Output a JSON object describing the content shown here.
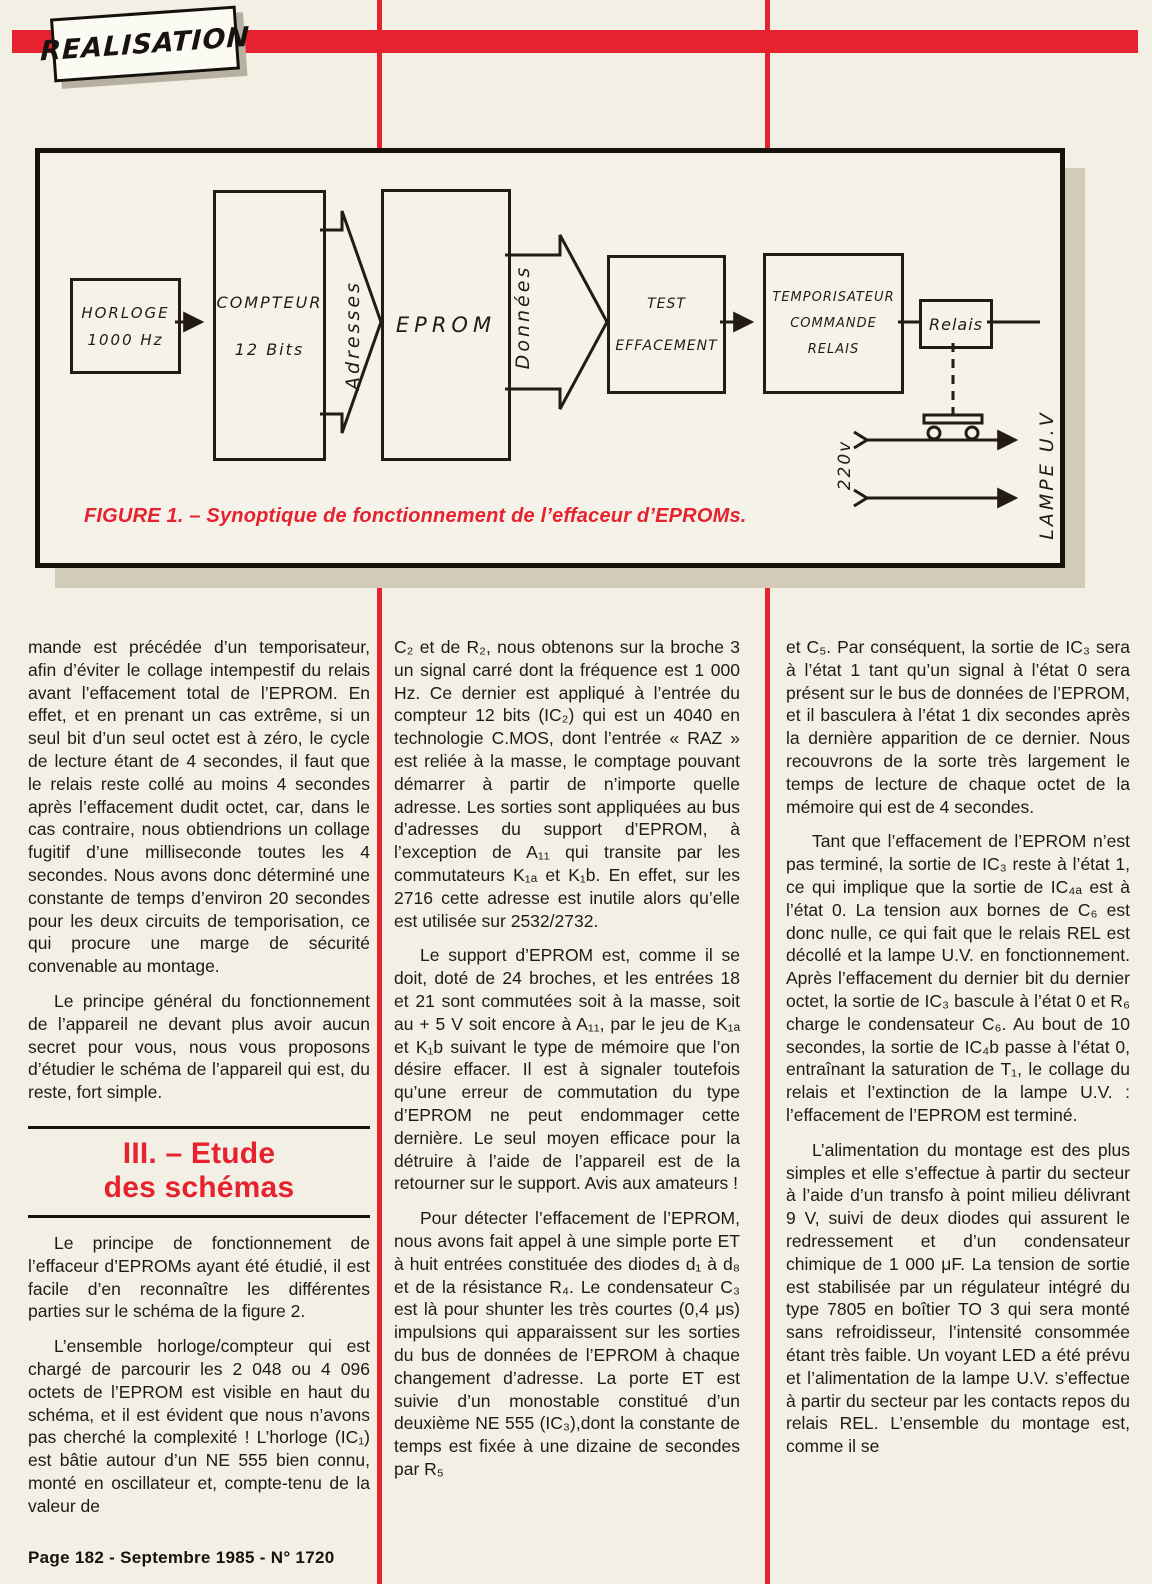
{
  "page": {
    "background": "#f2efe5",
    "accent": "#e6222e",
    "ink": "#201a14",
    "footer": "Page 182 - Septembre 1985 - N° 1720"
  },
  "masthead": {
    "badge": "REALISATION"
  },
  "figure1": {
    "caption": "FIGURE 1. – Synoptique de fonctionnement de l’effaceur d’EPROMs.",
    "blocks": {
      "horloge": {
        "line1": "HORLOGE",
        "line2": "1000 Hz"
      },
      "compteur": {
        "line1": "COMPTEUR",
        "line2": "12 Bits"
      },
      "eprom": {
        "line1": "EPROM"
      },
      "test": {
        "line1": "TEST",
        "line2": "EFFACEMENT"
      },
      "temporisateur": {
        "line1": "TEMPORISATEUR",
        "line2": "COMMANDE",
        "line3": "RELAIS"
      },
      "relais": {
        "line1": "Relais"
      }
    },
    "bus_labels": {
      "adresses": "Adresses",
      "donnees": "Données"
    },
    "wire_labels": {
      "mains": "220v",
      "lamp": "LAMPE U.V"
    }
  },
  "article": {
    "col1": {
      "p1": "mande est précédée d’un temporisateur, afin d’éviter le collage intempestif du relais avant l’effacement total de l’EPROM. En effet, et en prenant un cas extrême, si un seul bit d’un seul octet est à zéro, le cycle de lecture étant de 4 secondes, il faut que le relais reste collé au moins 4 secondes après l’effacement dudit octet, car, dans le cas contraire, nous obtiendrions un collage fugitif d’une milliseconde toutes les 4 secondes. Nous avons donc déterminé une constante de temps d’environ 20 secondes pour les deux circuits de temporisation, ce qui procure une marge de sécurité convenable au montage.",
      "p2": "Le principe général du fonctionnement de l’appareil ne devant plus avoir aucun secret pour vous, nous vous proposons d’étudier le schéma de l’appareil qui est, du reste, fort simple.",
      "heading_line1": "III. – Etude",
      "heading_line2": "des schémas",
      "p3": "Le principe de fonctionnement de l’effaceur d’EPROMs ayant été étudié, il est facile d’en reconnaître les différentes parties sur le schéma de la figure 2.",
      "p4": "L’ensemble horloge/compteur qui est chargé de parcourir les 2 048 ou 4 096 octets de l’EPROM est visible en haut du schéma, et il est évident que nous n’avons pas cherché la complexité ! L’horloge (IC₁) est bâtie autour d’un NE 555 bien connu, monté en oscillateur et, compte-tenu de la valeur de"
    },
    "col2": {
      "p1": "C₂ et de R₂, nous obtenons sur la broche 3 un signal carré dont la fréquence est 1 000 Hz. Ce dernier est appliqué à l’entrée du compteur 12 bits (IC₂) qui est un 4040 en technologie C.MOS, dont l’entrée « RAZ » est reliée à la masse, le comptage pouvant démarrer à partir de n’importe quelle adresse. Les sorties sont appliquées au bus d’adresses du support d’EPROM, à l’exception de A₁₁ qui transite par les commutateurs K₁ₐ et K₁b. En effet, sur les 2716 cette adresse est inutile alors qu’elle est utilisée sur 2532/2732.",
      "p2": "Le support d’EPROM est, comme il se doit, doté de 24 broches, et les entrées 18 et 21 sont commutées soit à la masse, soit au + 5 V soit encore à A₁₁, par le jeu de K₁ₐ et K₁b suivant le type de mémoire que l’on désire effacer. Il est à signaler toutefois qu’une erreur de commutation du type d’EPROM ne peut endommager cette dernière. Le seul moyen efficace pour la détruire à l’aide de l’appareil est de la retourner sur le support. Avis aux amateurs !",
      "p3": "Pour détecter l’effacement de l’EPROM, nous avons fait appel à une simple porte ET à huit entrées constituée des diodes d₁ à d₈ et de la résistance R₄. Le condensateur C₃ est là pour shunter les très courtes (0,4 μs) impulsions qui apparaissent sur les sorties du bus de données de l’EPROM à chaque changement d’adresse. La porte ET est suivie d’un monostable constitué d’un deuxième NE 555 (IC₃),dont la constante de temps est fixée à une dizaine de secondes par R₅"
    },
    "col3": {
      "p1": "et C₅. Par conséquent, la sortie de IC₃ sera à l’état 1 tant qu’un signal à l’état 0 sera présent sur le bus de données de l’EPROM, et il basculera à l’état 1 dix secondes après la dernière apparition de ce dernier. Nous recouvrons de la sorte très largement le temps de lecture de chaque octet de la mémoire qui est de 4 secondes.",
      "p2": "Tant que l’effacement de l’EPROM n’est pas terminé, la sortie de IC₃ reste à l’état 1, ce qui implique que la sortie de IC₄ₐ est à l’état 0. La tension aux bornes de C₆ est donc nulle, ce qui fait que le relais REL est décollé et la lampe U.V. en fonctionnement. Après l’effacement du dernier bit du dernier octet, la sortie de IC₃ bascule à l’état 0 et R₆ charge le condensateur C₆. Au bout de 10 secondes, la sortie de IC₄b passe à l’état 0, entraînant la saturation de T₁, le collage du relais et l’extinction de la lampe U.V. : l’effacement de l’EPROM est terminé.",
      "p3": "L’alimentation du montage est des plus simples et elle s’effectue à partir du secteur à l’aide d’un transfo à point milieu délivrant 9 V, suivi de deux diodes qui assurent le redressement et d’un condensateur chimique de 1 000 μF. La tension de sortie est stabilisée par un régulateur intégré du type 7805 en boîtier TO 3 qui sera monté sans refroidisseur, l’intensité consommée étant très faible. Un voyant LED a été prévu et l’alimentation de la lampe U.V. s’effectue à partir du secteur par les contacts repos du relais REL. L’ensemble du montage est, comme il se"
    }
  }
}
